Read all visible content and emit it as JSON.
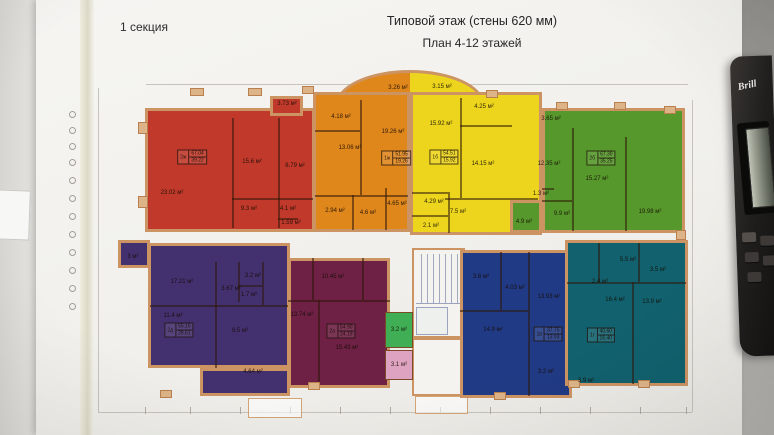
{
  "photo": {
    "section_label": "1 секция",
    "title_line1": "Типовой этаж (стены 620 мм)",
    "title_line2": "План 4-12 этажей",
    "calculator_brand": "Brill"
  },
  "colors": {
    "sheet": "#f1f0ec",
    "desk": "#a7a6a2",
    "wall": "#cd9463",
    "divider": "rgba(48,24,9,0.55)",
    "dim_line": "#c6c3bb"
  },
  "plan": {
    "wall_color": "#cd9463",
    "arc": {
      "rect": [
        336,
        70,
        484,
        104
      ]
    },
    "apartments": [
      {
        "id": "red",
        "color": "#c0392b",
        "rects": [
          [
            145,
            108,
            315,
            232
          ],
          [
            270,
            96,
            303,
            116
          ]
        ],
        "dividers": [
          [
            232,
            118,
            232,
            228
          ],
          [
            278,
            118,
            278,
            228
          ],
          [
            232,
            198,
            313,
            198
          ],
          [
            278,
            218,
            298,
            218
          ]
        ],
        "rooms": [
          {
            "label": "23.02 м²",
            "x": 172,
            "y": 193
          },
          {
            "label": "15.6 м²",
            "x": 252,
            "y": 162
          },
          {
            "label": "8.79 м²",
            "x": 295,
            "y": 166
          },
          {
            "label": "9.3 м²",
            "x": 249,
            "y": 209
          },
          {
            "label": "4.1 м²",
            "x": 288,
            "y": 209
          },
          {
            "label": "1.59 м²",
            "x": 291,
            "y": 223
          },
          {
            "label": "3.73 м²",
            "x": 287,
            "y": 104
          }
        ],
        "stamp": {
          "type": "2ж",
          "total": "67.04",
          "living": "39.22",
          "x": 192,
          "y": 157
        }
      },
      {
        "id": "orange",
        "color": "#e0871c",
        "rects": [
          [
            313,
            92,
            410,
            232
          ]
        ],
        "dividers": [
          [
            360,
            100,
            360,
            195
          ],
          [
            315,
            195,
            408,
            195
          ],
          [
            315,
            130,
            360,
            130
          ],
          [
            352,
            195,
            352,
            230
          ],
          [
            385,
            188,
            385,
            230
          ]
        ],
        "rooms": [
          {
            "label": "13.06 м²",
            "x": 350,
            "y": 148
          },
          {
            "label": "4.18 м²",
            "x": 341,
            "y": 117
          },
          {
            "label": "19.26 м²",
            "x": 393,
            "y": 132
          },
          {
            "label": "3.26 м²",
            "x": 398,
            "y": 88
          },
          {
            "label": "2.94 м²",
            "x": 335,
            "y": 211
          },
          {
            "label": "4.6 м²",
            "x": 368,
            "y": 213
          },
          {
            "label": "4.65 м²",
            "x": 397,
            "y": 204
          }
        ],
        "stamp": {
          "type": "1ж",
          "total": "51.95",
          "living": "19.26",
          "x": 396,
          "y": 158
        }
      },
      {
        "id": "yellow",
        "color": "#ecd51c",
        "rects": [
          [
            410,
            92,
            542,
            235
          ]
        ],
        "dividers": [
          [
            460,
            98,
            460,
            198
          ],
          [
            445,
            198,
            538,
            198
          ],
          [
            460,
            125,
            512,
            125
          ],
          [
            448,
            192,
            448,
            233
          ],
          [
            412,
            192,
            448,
            192
          ],
          [
            412,
            215,
            448,
            215
          ]
        ],
        "rooms": [
          {
            "label": "15.92 м²",
            "x": 441,
            "y": 124
          },
          {
            "label": "3.15 м²",
            "x": 442,
            "y": 87
          },
          {
            "label": "4.25 м²",
            "x": 484,
            "y": 107
          },
          {
            "label": "14.15 м²",
            "x": 483,
            "y": 164
          },
          {
            "label": "4.29 м²",
            "x": 434,
            "y": 202
          },
          {
            "label": "7.5 м²",
            "x": 458,
            "y": 212
          },
          {
            "label": "2.1 м²",
            "x": 431,
            "y": 226
          }
        ],
        "stamp": {
          "type": "1б",
          "total": "54.51",
          "living": "15.92",
          "x": 444,
          "y": 157
        }
      },
      {
        "id": "green",
        "color": "#56982c",
        "rects": [
          [
            542,
            108,
            685,
            233
          ],
          [
            510,
            200,
            542,
            233
          ]
        ],
        "dividers": [
          [
            572,
            128,
            572,
            231
          ],
          [
            625,
            137,
            625,
            231
          ],
          [
            542,
            200,
            572,
            200
          ],
          [
            542,
            188,
            554,
            188
          ]
        ],
        "rooms": [
          {
            "label": "3.65 м²",
            "x": 551,
            "y": 119
          },
          {
            "label": "12.35 м²",
            "x": 549,
            "y": 164
          },
          {
            "label": "15.27 м²",
            "x": 597,
            "y": 179
          },
          {
            "label": "19.98 м²",
            "x": 650,
            "y": 212
          },
          {
            "label": "9.9 м²",
            "x": 562,
            "y": 214
          },
          {
            "label": "1.3 м²",
            "x": 541,
            "y": 194
          },
          {
            "label": "4.9 м²",
            "x": 524,
            "y": 222
          }
        ],
        "stamp": {
          "type": "2б",
          "total": "67.30",
          "living": "35.25",
          "x": 601,
          "y": 158
        }
      },
      {
        "id": "purple",
        "color": "#43306f",
        "rects": [
          [
            148,
            243,
            290,
            368
          ],
          [
            200,
            368,
            290,
            396
          ],
          [
            118,
            240,
            150,
            268
          ]
        ],
        "dividers": [
          [
            150,
            305,
            288,
            305
          ],
          [
            215,
            262,
            215,
            368
          ],
          [
            238,
            262,
            238,
            302
          ],
          [
            238,
            285,
            262,
            285
          ],
          [
            262,
            262,
            262,
            305
          ]
        ],
        "rooms": [
          {
            "label": "3 м²",
            "x": 133,
            "y": 257
          },
          {
            "label": "17.21 м²",
            "x": 182,
            "y": 282
          },
          {
            "label": "3.67 м²",
            "x": 231,
            "y": 289
          },
          {
            "label": "3.2 м²",
            "x": 253,
            "y": 276
          },
          {
            "label": "1.7 м²",
            "x": 249,
            "y": 295
          },
          {
            "label": "11.4 м²",
            "x": 173,
            "y": 316
          },
          {
            "label": "9.5 м²",
            "x": 240,
            "y": 331
          },
          {
            "label": "4.64 м²",
            "x": 253,
            "y": 372
          }
        ],
        "stamp": {
          "type": "2д",
          "total": "55.16",
          "living": "28.61",
          "x": 179,
          "y": 330
        }
      },
      {
        "id": "maroon",
        "color": "#6e2144",
        "rects": [
          [
            288,
            258,
            390,
            388
          ]
        ],
        "dividers": [
          [
            312,
            258,
            312,
            300
          ],
          [
            362,
            258,
            362,
            300
          ],
          [
            288,
            300,
            390,
            300
          ],
          [
            318,
            300,
            318,
            386
          ]
        ],
        "rooms": [
          {
            "label": "10.45 м²",
            "x": 333,
            "y": 277
          },
          {
            "label": "13.74 м²",
            "x": 302,
            "y": 315
          },
          {
            "label": "15.43 м²",
            "x": 347,
            "y": 348
          }
        ],
        "stamp": {
          "type": "2а",
          "total": "54.90",
          "living": "24.19",
          "x": 341,
          "y": 331
        }
      },
      {
        "id": "navy",
        "color": "#213a85",
        "rects": [
          [
            460,
            250,
            572,
            398
          ]
        ],
        "dividers": [
          [
            500,
            252,
            500,
            310
          ],
          [
            528,
            252,
            528,
            396
          ],
          [
            460,
            310,
            528,
            310
          ]
        ],
        "rooms": [
          {
            "label": "3.6 м²",
            "x": 481,
            "y": 277
          },
          {
            "label": "4.03 м²",
            "x": 515,
            "y": 288
          },
          {
            "label": "13.93 м²",
            "x": 549,
            "y": 297
          },
          {
            "label": "14.9 м²",
            "x": 493,
            "y": 330
          },
          {
            "label": "3.2 м²",
            "x": 546,
            "y": 372
          }
        ],
        "stamp": {
          "type": "1в",
          "total": "37.75",
          "living": "13.93",
          "x": 548,
          "y": 334
        }
      },
      {
        "id": "teal",
        "color": "#11616e",
        "rects": [
          [
            565,
            240,
            688,
            386
          ]
        ],
        "dividers": [
          [
            638,
            243,
            638,
            282
          ],
          [
            567,
            282,
            686,
            282
          ],
          [
            632,
            282,
            632,
            384
          ],
          [
            598,
            243,
            598,
            282
          ]
        ],
        "rooms": [
          {
            "label": "5.5 м²",
            "x": 628,
            "y": 260
          },
          {
            "label": "3.5 м²",
            "x": 658,
            "y": 270
          },
          {
            "label": "2.4 м²",
            "x": 600,
            "y": 282
          },
          {
            "label": "16.4 м²",
            "x": 615,
            "y": 300
          },
          {
            "label": "13.9 м²",
            "x": 652,
            "y": 302
          },
          {
            "label": "3.9 м²",
            "x": 586,
            "y": 381
          }
        ],
        "stamp": {
          "type": "1г",
          "total": "40.60",
          "living": "16.40",
          "x": 601,
          "y": 335
        }
      }
    ],
    "small_rooms": [
      {
        "id": "storage-green",
        "label": "3.2 м²",
        "color": "#3fae54",
        "rect": [
          385,
          312,
          413,
          348
        ]
      },
      {
        "id": "storage-pink",
        "label": "3.1 м²",
        "color": "#dfa3c2",
        "rect": [
          385,
          350,
          413,
          380
        ]
      }
    ],
    "stairwell": {
      "outer": [
        412,
        248,
        465,
        338
      ],
      "stairs": [
        416,
        254,
        461,
        304
      ],
      "elevator": [
        416,
        307,
        448,
        335
      ],
      "corridor": [
        412,
        338,
        465,
        396
      ]
    },
    "porches": [
      [
        248,
        398,
        302,
        418
      ],
      [
        415,
        396,
        468,
        414
      ]
    ],
    "pilasters": [
      [
        138,
        122,
        10,
        12
      ],
      [
        138,
        196,
        10,
        12
      ],
      [
        190,
        88,
        14,
        8
      ],
      [
        248,
        88,
        14,
        8
      ],
      [
        302,
        86,
        12,
        8
      ],
      [
        486,
        90,
        12,
        8
      ],
      [
        556,
        102,
        12,
        8
      ],
      [
        614,
        102,
        12,
        8
      ],
      [
        664,
        106,
        12,
        8
      ],
      [
        160,
        390,
        12,
        8
      ],
      [
        308,
        382,
        12,
        8
      ],
      [
        494,
        392,
        12,
        8
      ],
      [
        568,
        380,
        12,
        8
      ],
      [
        638,
        380,
        12,
        8
      ],
      [
        676,
        230,
        10,
        10
      ]
    ],
    "dim_lines": [
      [
        98,
        88,
        98,
        412
      ],
      [
        692,
        100,
        692,
        412
      ],
      [
        98,
        412,
        692,
        412
      ],
      [
        146,
        84,
        688,
        84
      ]
    ],
    "grid_bubbles": {
      "x": 73,
      "ys": [
        115,
        131,
        147,
        163,
        181,
        199,
        217,
        235,
        253,
        271,
        289,
        307
      ]
    },
    "ticks": {
      "y": 407,
      "xs": [
        145,
        190,
        240,
        290,
        340,
        390,
        440,
        490,
        540,
        590,
        640,
        686
      ]
    }
  }
}
